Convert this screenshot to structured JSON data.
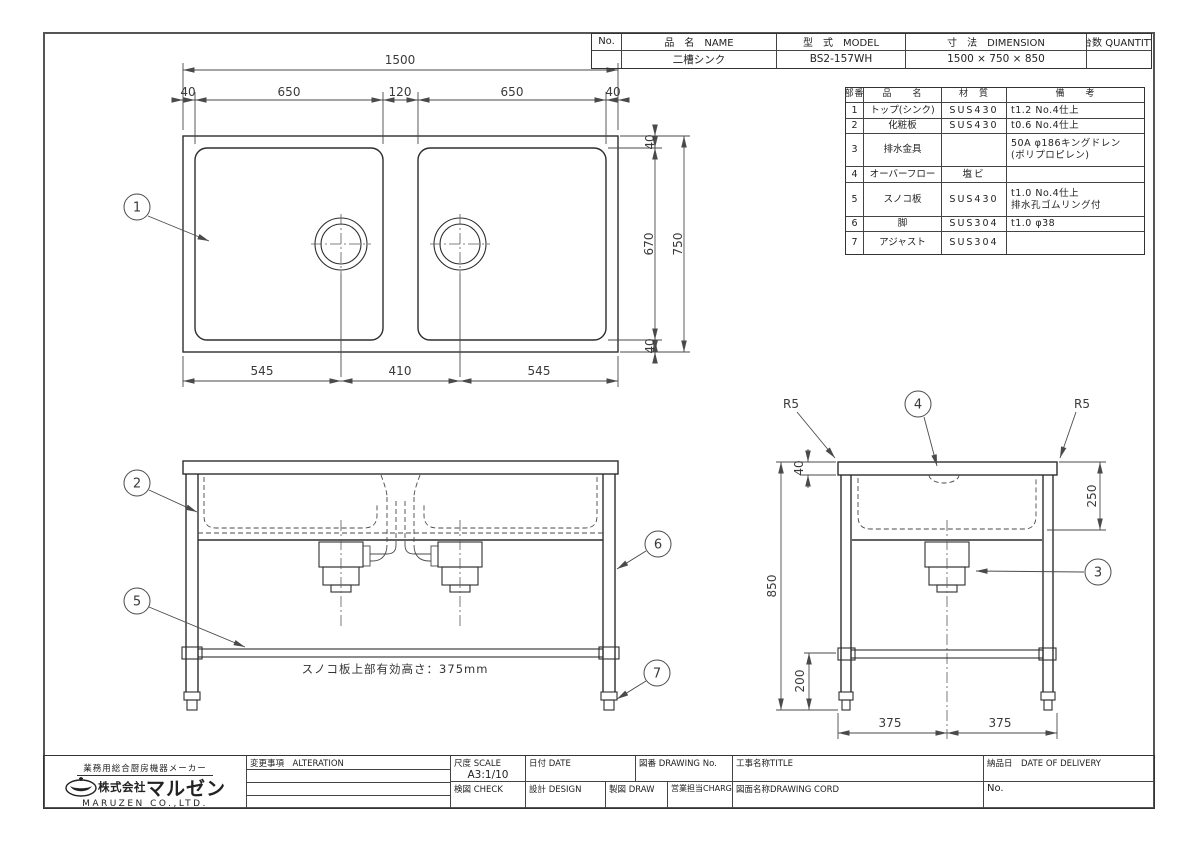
{
  "header_table": {
    "columns": {
      "no": "No.",
      "name": "品　名　NAME",
      "model": "型　式　MODEL",
      "dimension": "寸　法　DIMENSION",
      "quantity": "台数 QUANTITY"
    },
    "row": {
      "no": "",
      "name": "二槽シンク",
      "model": "BS2-157WH",
      "dimension": "1500 × 750 × 850",
      "quantity": ""
    }
  },
  "parts_table": {
    "columns": {
      "ref": "部番",
      "name": "品　　名",
      "material": "材　質",
      "remarks": "備　　考"
    },
    "rows": [
      {
        "ref": "1",
        "name": "トップ(シンク)",
        "material": "SUS430",
        "remarks": "t1.2 No.4仕上",
        "remarks2": ""
      },
      {
        "ref": "2",
        "name": "化粧板",
        "material": "SUS430",
        "remarks": "t0.6 No.4仕上",
        "remarks2": ""
      },
      {
        "ref": "3",
        "name": "排水金具",
        "material": "",
        "remarks": "50A φ186キングドレン",
        "remarks2": "(ポリプロピレン)"
      },
      {
        "ref": "4",
        "name": "オーバーフロー",
        "material": "塩ビ",
        "remarks": "",
        "remarks2": ""
      },
      {
        "ref": "5",
        "name": "スノコ板",
        "material": "SUS430",
        "remarks": "t1.0 No.4仕上",
        "remarks2": "排水孔ゴムリング付"
      },
      {
        "ref": "6",
        "name": "脚",
        "material": "SUS304",
        "remarks": "t1.0 φ38",
        "remarks2": ""
      },
      {
        "ref": "7",
        "name": "アジャスト",
        "material": "SUS304",
        "remarks": "",
        "remarks2": ""
      }
    ]
  },
  "plan": {
    "balloon": "1",
    "dim_overall_w": "1500",
    "dim_top": [
      "40",
      "650",
      "120",
      "650",
      "40"
    ],
    "dim_right": [
      "40",
      "670",
      "40"
    ],
    "dim_overall_h": "750",
    "dim_bottom": [
      "545",
      "410",
      "545"
    ]
  },
  "front": {
    "balloons": [
      "2",
      "5",
      "6",
      "7"
    ],
    "note": "スノコ板上部有効高さ：375mm"
  },
  "side": {
    "balloons": [
      "4",
      "3"
    ],
    "fillet": "R5",
    "dim_top_thickness": "40",
    "dim_basin_depth": "250",
    "dim_overall_h": "850",
    "dim_leg_bottom": "200",
    "dim_half": [
      "375",
      "375"
    ]
  },
  "title_block": {
    "alteration_label": "変更事項　ALTERATION",
    "scale_label": "尺度 SCALE",
    "scale_value": "A3:1/10",
    "date_label": "日付 DATE",
    "drawing_no_label": "図番 DRAWING No.",
    "title_label": "工事名称TITLE",
    "delivery_label": "納品日　DATE OF DELIVERY",
    "check_label": "検図 CHECK",
    "design_label": "設計 DESIGN",
    "draw_label": "製図 DRAW",
    "charge_label": "営業担当CHARGE",
    "drawing_cord_label": "図面名称DRAWING CORD",
    "no_label": "No."
  },
  "company": {
    "tagline": "業務用総合厨房機器メーカー",
    "prefix": "株式会社",
    "name": "マルゼン",
    "name_en": "MARUZEN CO.,LTD."
  }
}
